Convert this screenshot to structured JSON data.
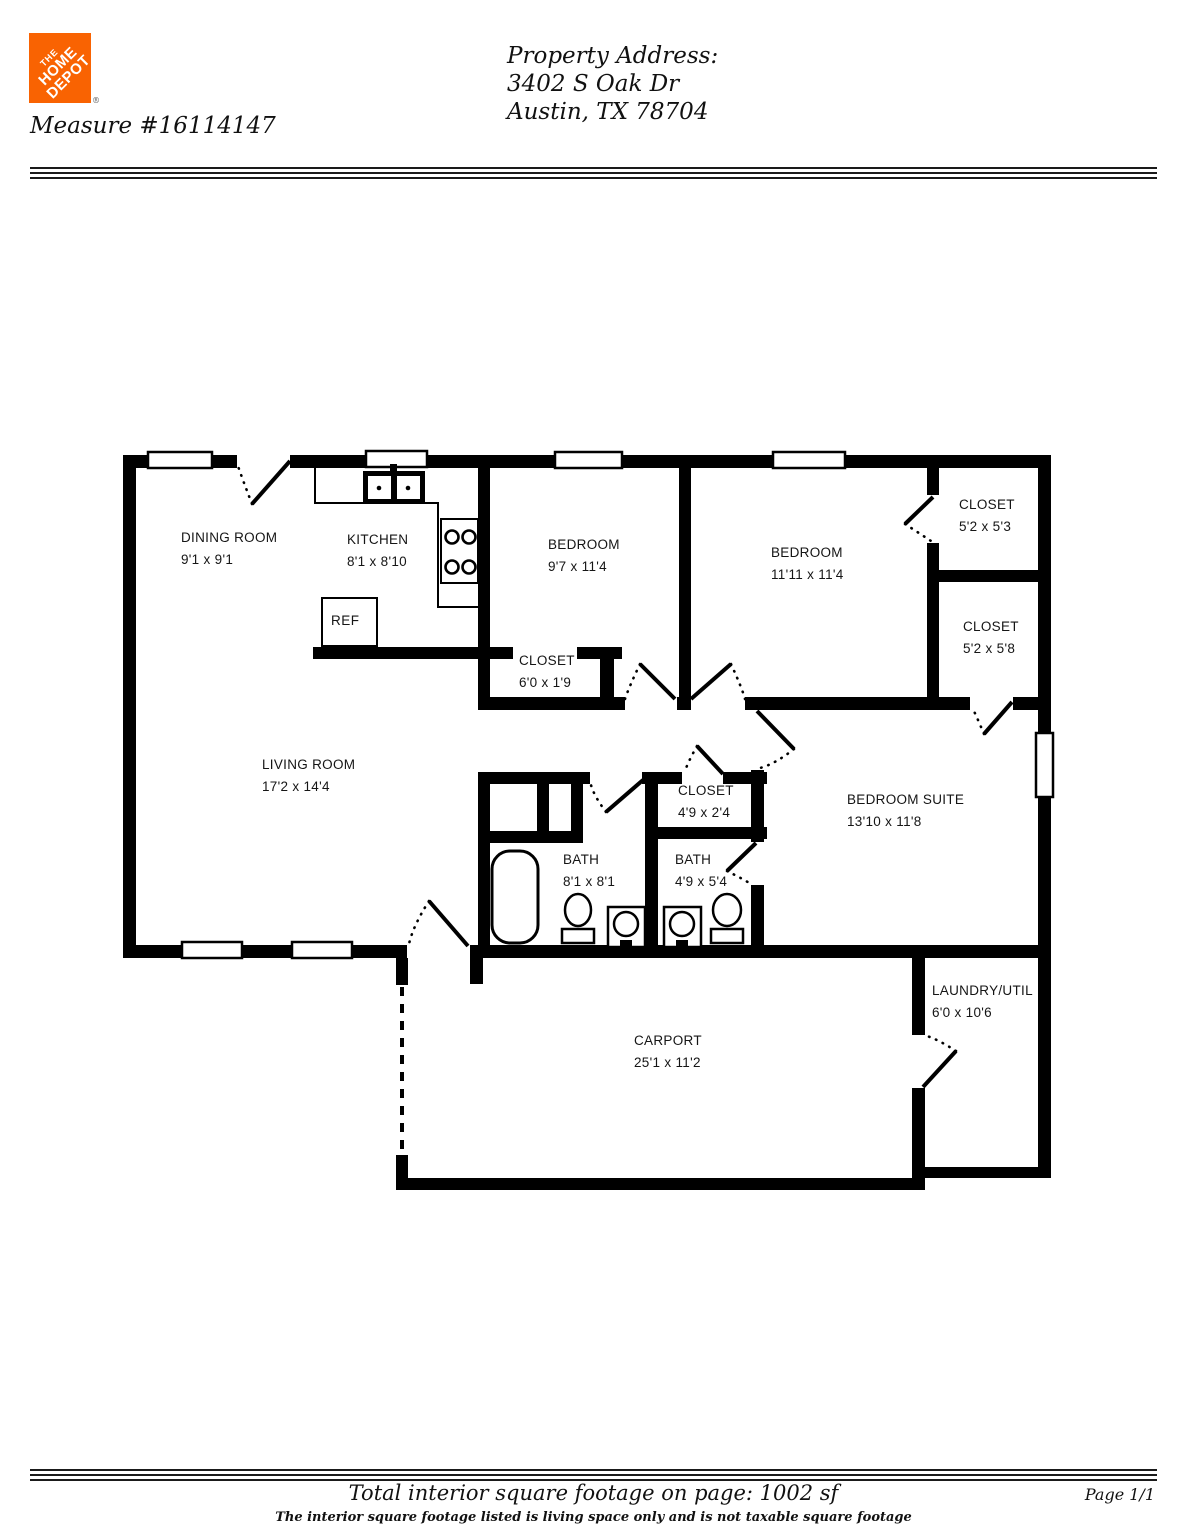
{
  "header": {
    "logo": {
      "brand_line1": "THE",
      "brand_line2": "HOME",
      "brand_line3": "DEPOT",
      "color": "#f96302",
      "registered_mark": "®"
    },
    "measure_number": "Measure #16114147",
    "property_address": {
      "label": "Property Address:",
      "line1": "3402 S Oak Dr",
      "line2": "Austin, TX 78704"
    }
  },
  "floor_plan": {
    "rooms": [
      {
        "name": "DINING ROOM",
        "dims": "9'1 x 9'1"
      },
      {
        "name": "KITCHEN",
        "dims": "8'1 x 8'10"
      },
      {
        "name": "BEDROOM",
        "dims": "9'7 x 11'4"
      },
      {
        "name": "BEDROOM",
        "dims": "11'11 x 11'4"
      },
      {
        "name": "CLOSET",
        "dims": "5'2 x 5'3"
      },
      {
        "name": "CLOSET",
        "dims": "5'2 x 5'8"
      },
      {
        "name": "CLOSET",
        "dims": "6'0 x 1'9"
      },
      {
        "name": "LIVING ROOM",
        "dims": "17'2 x 14'4"
      },
      {
        "name": "CLOSET",
        "dims": "4'9 x 2'4"
      },
      {
        "name": "BATH",
        "dims": "8'1 x 8'1"
      },
      {
        "name": "BATH",
        "dims": "4'9 x 5'4"
      },
      {
        "name": "BEDROOM SUITE",
        "dims": "13'10 x 11'8"
      },
      {
        "name": "LAUNDRY/UTIL",
        "dims": "6'0 x 10'6"
      },
      {
        "name": "CARPORT",
        "dims": "25'1 x 11'2"
      }
    ],
    "fixture_labels": {
      "refrigerator": "REF"
    }
  },
  "footer": {
    "total_text": "Total interior square footage on page: 1002 sf",
    "disclaimer": "The interior square footage listed is living space only and is not taxable square footage",
    "page_label": "Page 1/1"
  }
}
